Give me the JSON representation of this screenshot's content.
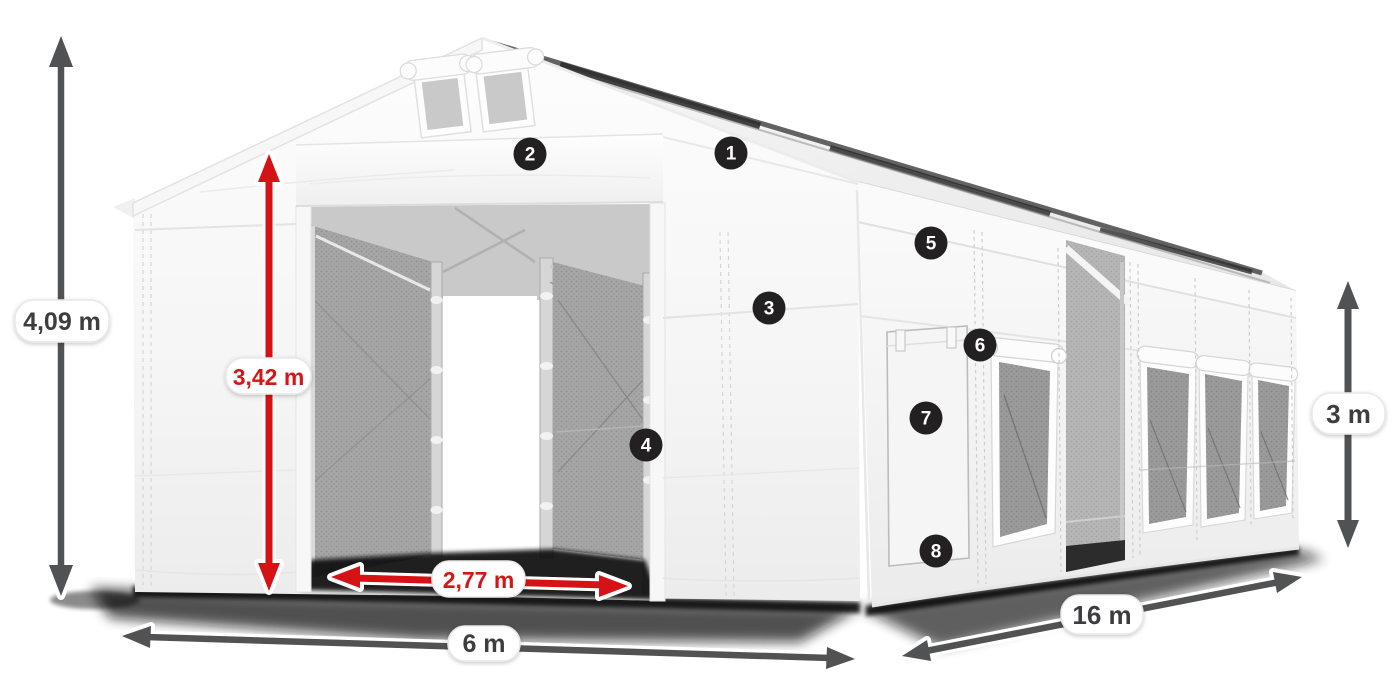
{
  "figure": {
    "title": "Industrial storage tent with dimensions and feature callouts",
    "type": "product-dimension-diagram"
  },
  "dimensions": {
    "total_height": "4,09 m",
    "entrance_height": "3,42 m",
    "entrance_width": "2,77 m",
    "width": "6 m",
    "length": "16 m",
    "side_height": "3 m"
  },
  "callouts": {
    "c1": "1",
    "c2": "2",
    "c3": "3",
    "c4": "4",
    "c5": "5",
    "c6": "6",
    "c7": "7",
    "c8": "8"
  },
  "colors": {
    "accent_red": "#d51317",
    "arrow_gray": "#515254",
    "marker_bg": "#232021",
    "marker_text": "#ffffff",
    "tent_white": "#f6f6f6",
    "mesh_gray": "#a3a3a3"
  }
}
